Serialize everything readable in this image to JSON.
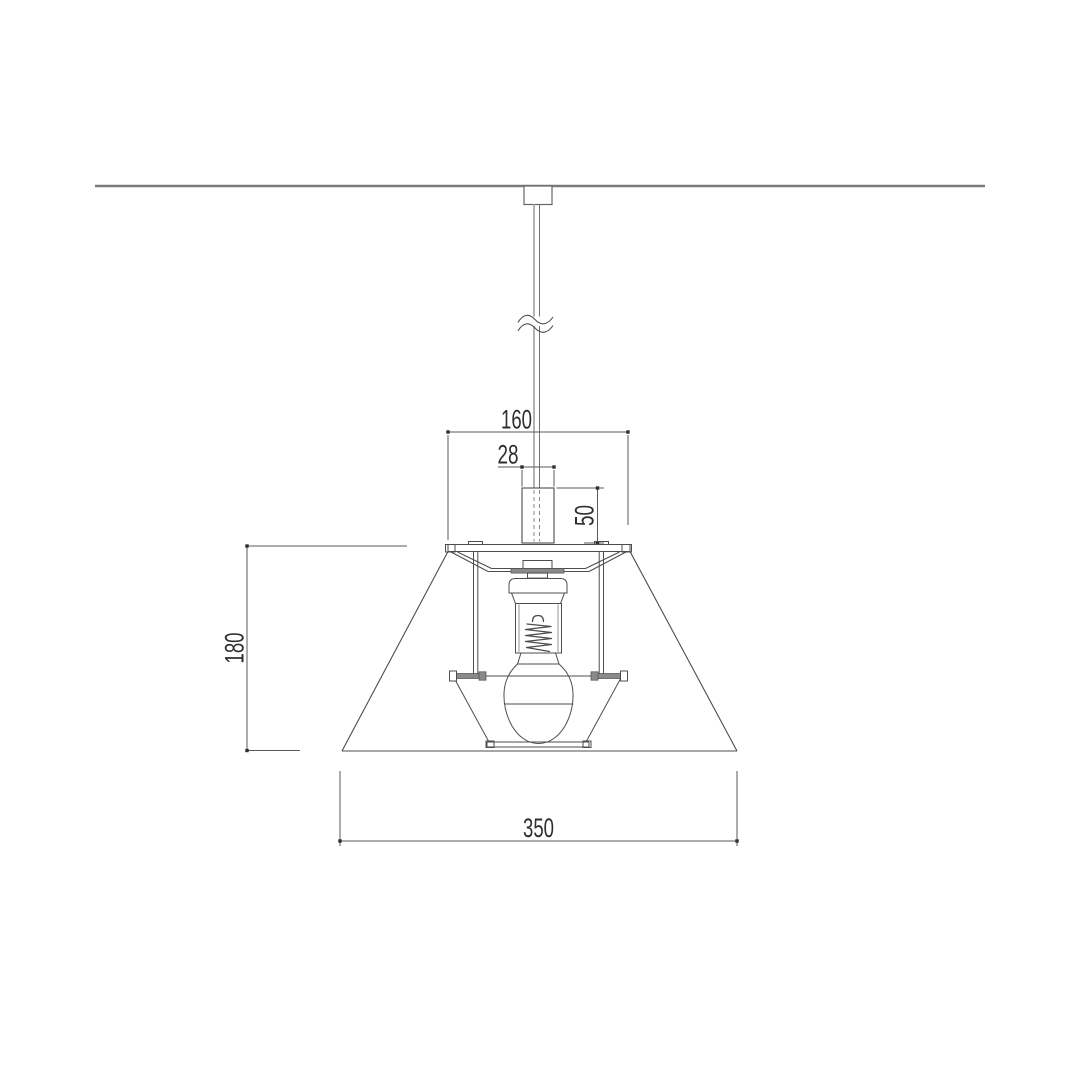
{
  "page": {
    "background": "#ffffff"
  },
  "colors": {
    "background": "#ffffff",
    "line": "#4d4d4d",
    "dim": "#5a5a5a",
    "text": "#2f2f2f",
    "ceiling": "#7a7a7a",
    "cord": "#b3b3b3",
    "cord_dark": "#707070",
    "hidden": "#8a8a8a",
    "bar_fill": "#8a8a8a"
  },
  "dimensions": {
    "top_plate_width": "160",
    "cord_cover_width": "28",
    "cord_cover_height": "50",
    "shade_height": "180",
    "shade_bottom_width": "350"
  }
}
